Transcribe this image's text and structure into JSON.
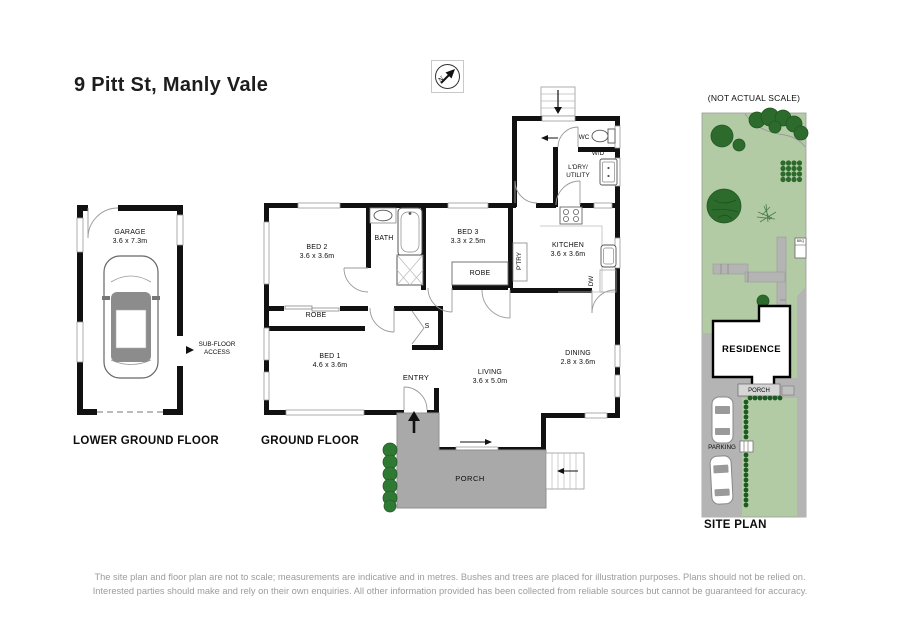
{
  "title": "9 Pitt St, Manly Vale",
  "compass_letter": "N",
  "scale_note": "(NOT ACTUAL SCALE)",
  "lower_floor": {
    "label": "LOWER GROUND FLOOR",
    "garage_name": "GARAGE",
    "garage_dims": "3.6 x 7.3m",
    "subfloor_line1": "SUB-FLOOR",
    "subfloor_line2": "ACCESS"
  },
  "ground_floor": {
    "label": "GROUND FLOOR",
    "bed2_name": "BED 2",
    "bed2_dims": "3.6 x 3.6m",
    "bath": "BATH",
    "bed3_name": "BED 3",
    "bed3_dims": "3.3 x 2.5m",
    "robe_bed3": "ROBE",
    "ptry": "P'TRY",
    "kitchen_name": "KITCHEN",
    "kitchen_dims": "3.6 x 3.6m",
    "dw": "DW",
    "wc": "WC",
    "wd": "W/D",
    "ldry_line1": "L'DRY/",
    "ldry_line2": "UTILITY",
    "robe_hall": "ROBE",
    "bed1_name": "BED 1",
    "bed1_dims": "4.6 x 3.6m",
    "storage": "S",
    "entry": "ENTRY",
    "living_name": "LIVING",
    "living_dims": "3.6 x 5.0m",
    "dining_name": "DINING",
    "dining_dims": "2.8 x 3.6m",
    "porch": "PORCH"
  },
  "site_plan": {
    "label": "SITE PLAN",
    "residence": "RESIDENCE",
    "porch": "PORCH",
    "parking": "PARKING",
    "bbq": "BBQ"
  },
  "disclaimer_line1": "The site plan and floor plan are not to scale; measurements are indicative and in metres. Bushes and trees are placed for illustration purposes. Plans should not be relied on.",
  "disclaimer_line2": "Interested parties should make and rely on their own enquiries. All other information provided has been collected from reliable sources but cannot be guaranteed for accuracy.",
  "colors": {
    "wall": "#111111",
    "porch_gray": "#a9a9a9",
    "path_gray": "#b4b4b4",
    "lawn_green": "#b3cba5",
    "tree_green": "#2c6b2c",
    "hedge_green": "#1d5a21",
    "disclaimer_gray": "#9c9c9c"
  }
}
